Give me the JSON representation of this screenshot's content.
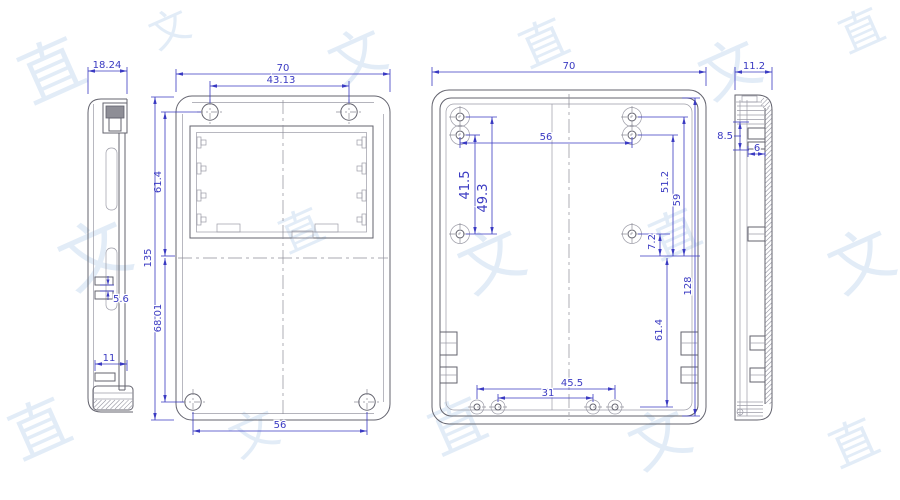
{
  "drawing": {
    "views": [
      {
        "id": "side-left",
        "label": "left side section view",
        "dims": {
          "overall_width": "18.24",
          "tab_gap": "5.6",
          "clip_width": "11"
        }
      },
      {
        "id": "front",
        "label": "front view",
        "dims": {
          "overall_width": "70",
          "top_hole_span": "43.13",
          "recess_height": "61.4",
          "overall_height": "135",
          "lower_section": "68.01",
          "bottom_hole_span": "56"
        }
      },
      {
        "id": "back",
        "label": "inner back view",
        "dims": {
          "overall_width": "70",
          "top_hole_span": "56",
          "boss_span_a": "41.5",
          "boss_span_b": "49.3",
          "right_a": "51.2",
          "right_b": "59",
          "right_c": "7.2",
          "inner_height": "128",
          "lower_height": "61.4",
          "bottom_span_a": "45.5",
          "bottom_span_b": "31"
        }
      },
      {
        "id": "side-right",
        "label": "right side section view",
        "dims": {
          "overall_width": "11.2",
          "depth_a": "8.5",
          "tab_width": "6"
        }
      }
    ]
  },
  "watermark": {
    "char_a": "直",
    "char_b": "文"
  },
  "colors": {
    "dimension": "#3a3ac2",
    "outline": "#63636e",
    "outline_light": "#9b9ba6",
    "centerline": "#8d8d98",
    "watermark": "#dde9f6",
    "background": "#ffffff"
  }
}
